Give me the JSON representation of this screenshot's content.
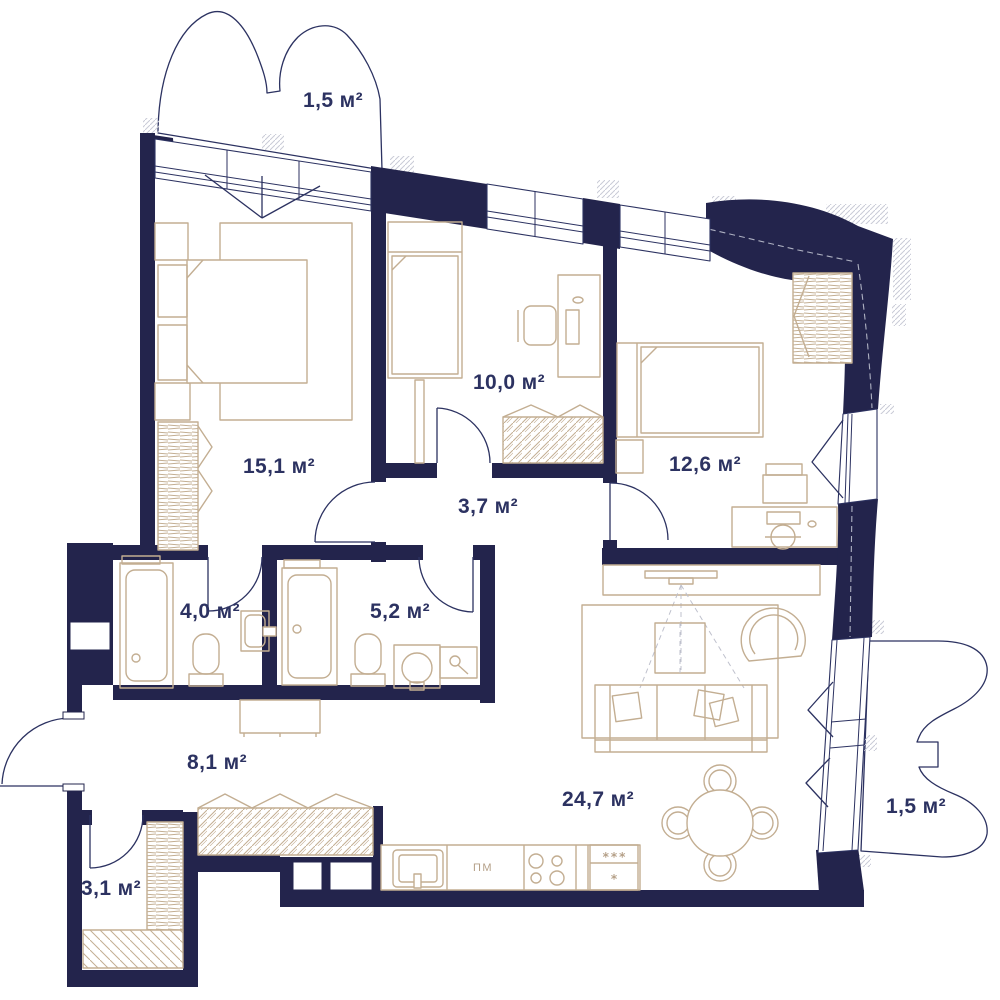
{
  "plan": {
    "type": "apartment-floor-plan",
    "colors": {
      "wall": "#23244c",
      "thin_line": "#2c3261",
      "furniture": "#c3ae92",
      "label_text": "#2c3261",
      "gray_hatch": "#c9cbd6",
      "background": "#ffffff"
    },
    "rooms": [
      {
        "id": "balcony-top",
        "label": "1,5 м²"
      },
      {
        "id": "bedroom-main",
        "label": "15,1 м²"
      },
      {
        "id": "bedroom-2",
        "label": "10,0 м²"
      },
      {
        "id": "bedroom-3",
        "label": "12,6 м²"
      },
      {
        "id": "hall",
        "label": "3,7 м²"
      },
      {
        "id": "bathroom-1",
        "label": "4,0 м²"
      },
      {
        "id": "bathroom-2",
        "label": "5,2 м²"
      },
      {
        "id": "corridor",
        "label": "8,1 м²"
      },
      {
        "id": "living-kitchen",
        "label": "24,7 м²"
      },
      {
        "id": "storage",
        "label": "3,1 м²"
      },
      {
        "id": "balcony-right",
        "label": "1,5 м²"
      }
    ],
    "kitchen": {
      "dishwasher_label": "ПМ",
      "freezer_stars": "***",
      "fridge_star": "*"
    }
  }
}
